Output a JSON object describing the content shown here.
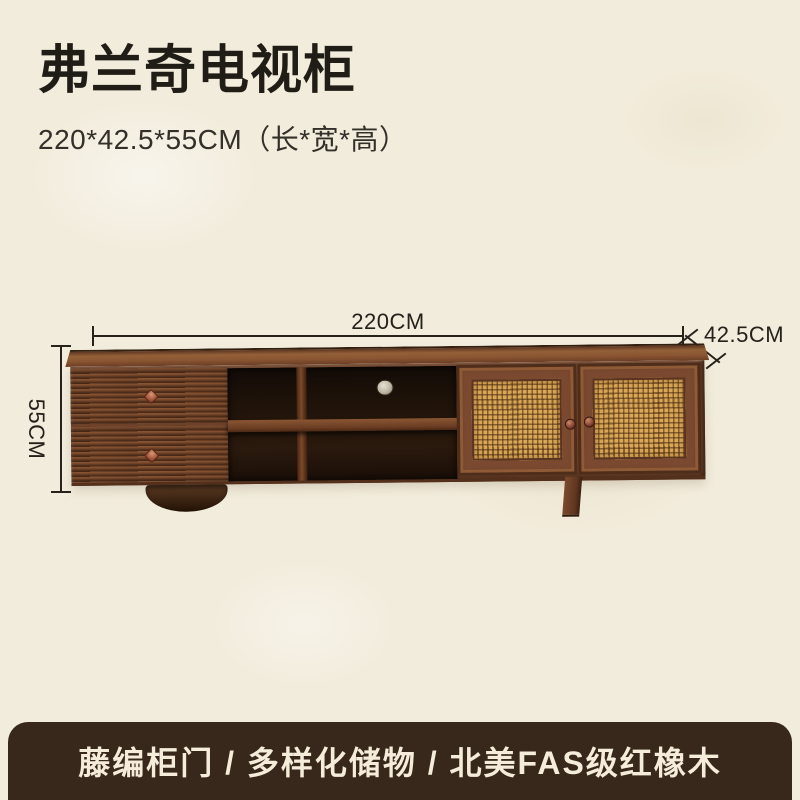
{
  "header": {
    "title": "弗兰奇电视柜",
    "subtitle": "220*42.5*55CM（长*宽*高）"
  },
  "diagram": {
    "width_label": "220CM",
    "depth_label": "42.5CM",
    "height_label": "55CM"
  },
  "product": {
    "length_cm": "220",
    "depth_cm": "42.5",
    "height_cm": "55"
  },
  "banner": {
    "text": "藤编柜门 / 多样化储物 / 北美FAS级红橡木"
  },
  "colors": {
    "background": "#f2ecdc",
    "text": "#221e18",
    "banner_background": "#37281b",
    "banner_text": "#f5ecd9",
    "wood_main": "#6e4229",
    "wood_dark": "#4e2d1a",
    "rattan": "#d9a757",
    "dimension_line": "#26221c"
  }
}
